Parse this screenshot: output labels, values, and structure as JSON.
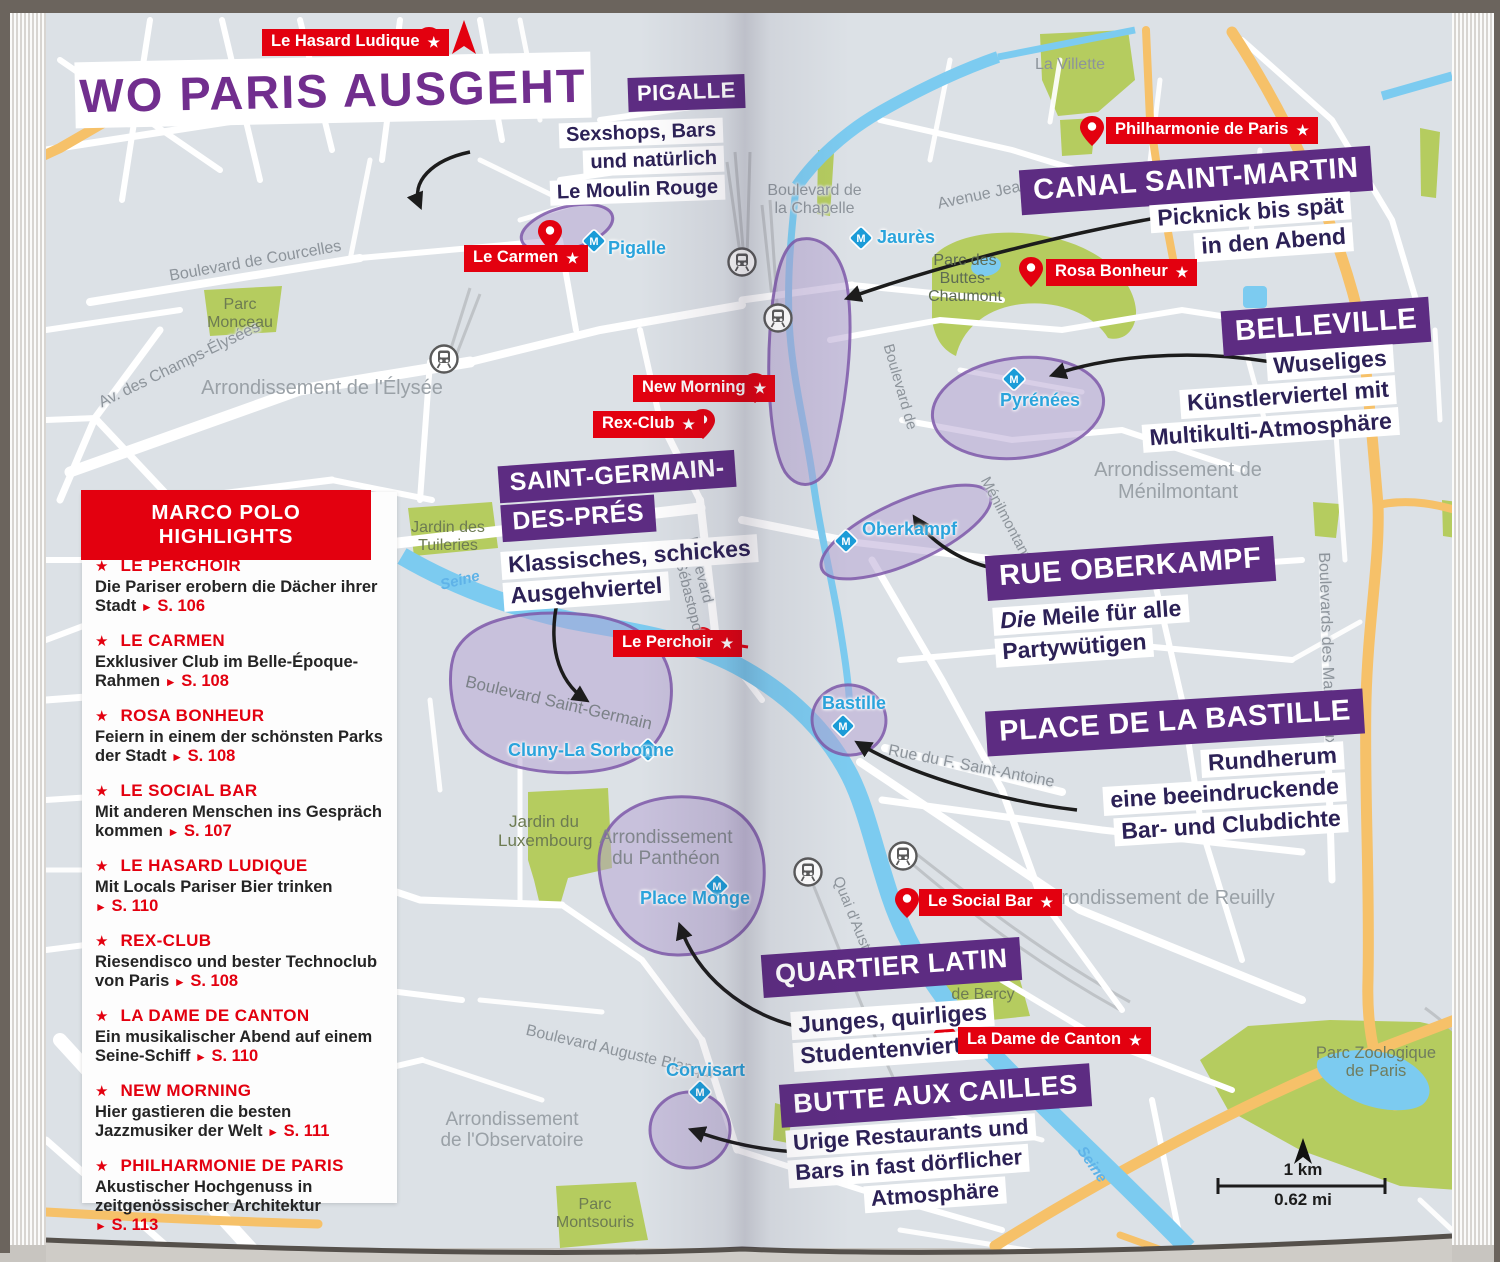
{
  "title": "WO PARIS AUSGEHT",
  "metro_icon_letter": "M",
  "colors": {
    "red": "#e3000f",
    "purple": "#5d2c82",
    "title_purple": "#712e8e",
    "metro_blue": "#1b9cd8",
    "park_green": "#b5cc5f",
    "water_blue": "#7ccbf0",
    "road_orange": "#f6c169",
    "note_ink": "#2c2156"
  },
  "highlights": {
    "header": "MARCO POLO HIGHLIGHTS",
    "star": "★",
    "arrow": "►",
    "items": [
      {
        "name": "LE PERCHOIR",
        "desc": "Die Pariser erobern die Dächer ihrer Stadt",
        "page": "S. 106"
      },
      {
        "name": "LE CARMEN",
        "desc": "Exklusiver Club im Belle-Époque-Rahmen",
        "page": "S. 108"
      },
      {
        "name": "ROSA BONHEUR",
        "desc": "Feiern in einem der schönsten Parks der Stadt",
        "page": "S. 108"
      },
      {
        "name": "LE SOCIAL BAR",
        "desc": "Mit anderen Menschen ins Gespräch kommen",
        "page": "S. 107"
      },
      {
        "name": "LE HASARD LUDIQUE",
        "desc": "Mit Locals Pariser Bier trinken",
        "page": "S. 110"
      },
      {
        "name": "REX-CLUB",
        "desc": "Riesendisco und bester Technoclub von Paris",
        "page": "S. 108"
      },
      {
        "name": "LA DAME DE CANTON",
        "desc": "Ein musikalischer Abend auf einem Seine-Schiff",
        "page": "S. 110"
      },
      {
        "name": "NEW MORNING",
        "desc": "Hier gastieren die besten Jazzmusiker der Welt",
        "page": "S. 111"
      },
      {
        "name": "PHILHARMONIE DE PARIS",
        "desc": "Akustischer Hochgenuss in zeitgenössi­scher Architektur",
        "page": "S. 113"
      }
    ]
  },
  "districts": [
    {
      "label_lines": [
        "PIGALLE"
      ],
      "note_lines": [
        "Sexshops, Bars",
        "und natürlich",
        "Le Moulin Rouge"
      ]
    },
    {
      "label_lines": [
        "CANAL SAINT-MARTIN"
      ],
      "note_lines": [
        "Picknick bis spät",
        "in den Abend"
      ]
    },
    {
      "label_lines": [
        "BELLEVILLE"
      ],
      "note_lines": [
        "Wuseliges",
        "Künstlerviertel mit",
        "Multikulti-Atmosphäre"
      ]
    },
    {
      "label_lines": [
        "SAINT-GERMAIN-",
        "DES-PRÉS"
      ],
      "note_lines": [
        "Klassisches, schickes",
        "Ausgehviertel"
      ]
    },
    {
      "label_lines": [
        "RUE OBERKAMPF"
      ],
      "note_italic": "Die",
      "note_lines": [
        "Meile für alle",
        "Partywütigen"
      ]
    },
    {
      "label_lines": [
        "PLACE DE LA BASTILLE"
      ],
      "note_lines": [
        "Rundherum",
        "eine beeindruckende",
        "Bar- und Clubdichte"
      ]
    },
    {
      "label_lines": [
        "QUARTIER LATIN"
      ],
      "note_lines": [
        "Junges, quirliges",
        "Studentenviertel"
      ]
    },
    {
      "label_lines": [
        "BUTTE AUX CAILLES"
      ],
      "note_lines": [
        "Urige Restaurants und",
        "Bars in fast dörflicher",
        "Atmosphäre"
      ]
    }
  ],
  "pois": [
    {
      "name": "Le Hasard Ludique"
    },
    {
      "name": "Le Carmen"
    },
    {
      "name": "Philharmonie de Paris"
    },
    {
      "name": "Rosa Bonheur"
    },
    {
      "name": "New Morning"
    },
    {
      "name": "Rex-Club"
    },
    {
      "name": "Le Perchoir"
    },
    {
      "name": "Le Social Bar"
    },
    {
      "name": "La Dame de Canton"
    }
  ],
  "metro": [
    "Pigalle",
    "Jaurès",
    "Pyrénées",
    "Oberkampf",
    "Bastille",
    "Cluny-La Sorbonne",
    "Place Monge",
    "Corvisart"
  ],
  "map_text": {
    "streets": [
      {
        "lines": [
          "Boulevard de Courcelles"
        ]
      },
      {
        "lines": [
          "Av. des Champs-Élysées"
        ]
      },
      {
        "lines": [
          "Boulevard",
          "de Sébastopol"
        ]
      },
      {
        "lines": [
          "Boulevard de",
          "la Chapelle"
        ]
      },
      {
        "lines": [
          "Avenue Jean Jaurès"
        ]
      },
      {
        "lines": [
          "Boulevard de"
        ]
      },
      {
        "lines": [
          "Ménilmontant"
        ]
      },
      {
        "lines": [
          "Boulevards des Maréchaux"
        ]
      },
      {
        "lines": [
          "Rue du F. Saint-Antoine"
        ]
      },
      {
        "lines": [
          "Quai d'Austerlitz"
        ]
      },
      {
        "lines": [
          "Boulevard Saint-Germain"
        ]
      },
      {
        "lines": [
          "Boulevard Auguste Blanqui"
        ]
      }
    ],
    "areas": [
      {
        "lines": [
          "Arrondissement de l'Élysée"
        ]
      },
      {
        "lines": [
          "Arrondissement de",
          "Ménilmontant"
        ]
      },
      {
        "lines": [
          "Arrondissement de Reuilly"
        ]
      },
      {
        "lines": [
          "Arrondissement",
          "du Panthéon"
        ]
      },
      {
        "lines": [
          "Arrondissement",
          "de l'Observatoire"
        ]
      }
    ],
    "parks": [
      {
        "lines": [
          "Parc",
          "Monceau"
        ]
      },
      {
        "lines": [
          "Jardin des",
          "Tuileries"
        ]
      },
      {
        "lines": [
          "La Villette"
        ]
      },
      {
        "lines": [
          "Parc des",
          "Buttes-Chaumont"
        ]
      },
      {
        "lines": [
          "Jardin du",
          "Luxembourg"
        ]
      },
      {
        "lines": [
          "Parc",
          "de Bercy"
        ]
      },
      {
        "lines": [
          "Parc Zoologique",
          "de Paris"
        ]
      },
      {
        "lines": [
          "Parc",
          "Montsouris"
        ]
      }
    ],
    "rivers": [
      {
        "name": "Seine"
      },
      {
        "name": "Seine"
      }
    ]
  },
  "scale": {
    "km": "1 km",
    "mi": "0.62 mi"
  }
}
